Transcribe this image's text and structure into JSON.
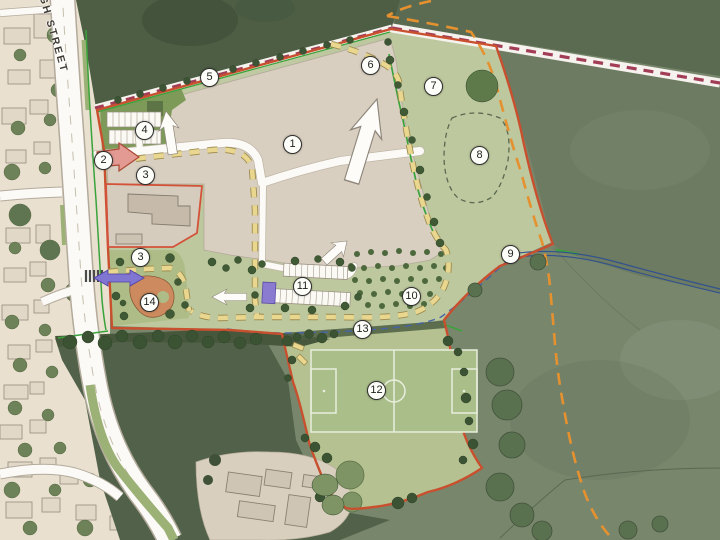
{
  "map": {
    "street_label": "HIGH STREET",
    "markers": [
      {
        "label": "1",
        "x": 293,
        "y": 145
      },
      {
        "label": "2",
        "x": 104,
        "y": 161
      },
      {
        "label": "3",
        "x": 146,
        "y": 176
      },
      {
        "label": "4",
        "x": 145,
        "y": 131
      },
      {
        "label": "5",
        "x": 210,
        "y": 78
      },
      {
        "label": "6",
        "x": 371,
        "y": 66
      },
      {
        "label": "7",
        "x": 434,
        "y": 87
      },
      {
        "label": "8",
        "x": 480,
        "y": 156
      },
      {
        "label": "9",
        "x": 511,
        "y": 255
      },
      {
        "label": "10",
        "x": 412,
        "y": 297
      },
      {
        "label": "11",
        "x": 303,
        "y": 287
      },
      {
        "label": "3",
        "x": 141,
        "y": 258
      },
      {
        "label": "12",
        "x": 377,
        "y": 391
      },
      {
        "label": "13",
        "x": 363,
        "y": 330
      },
      {
        "label": "14",
        "x": 150,
        "y": 303
      }
    ],
    "colors": {
      "site_boundary_red": "#c8502f",
      "right_of_way_orange_dash": "#e59130",
      "footpath_yellow_dash": "#ead78f",
      "hedgerow_green_line": "#3aa33c",
      "stripe_path_maroon_dash": "#a13d56",
      "watercourse_blue": "#31518f",
      "crossing_arrow_purple": "#8076d2",
      "access_arrow_pink": "#e29a93",
      "play_area_orange": "#cd8a5e",
      "pitch_green": "#aabe8a"
    }
  }
}
